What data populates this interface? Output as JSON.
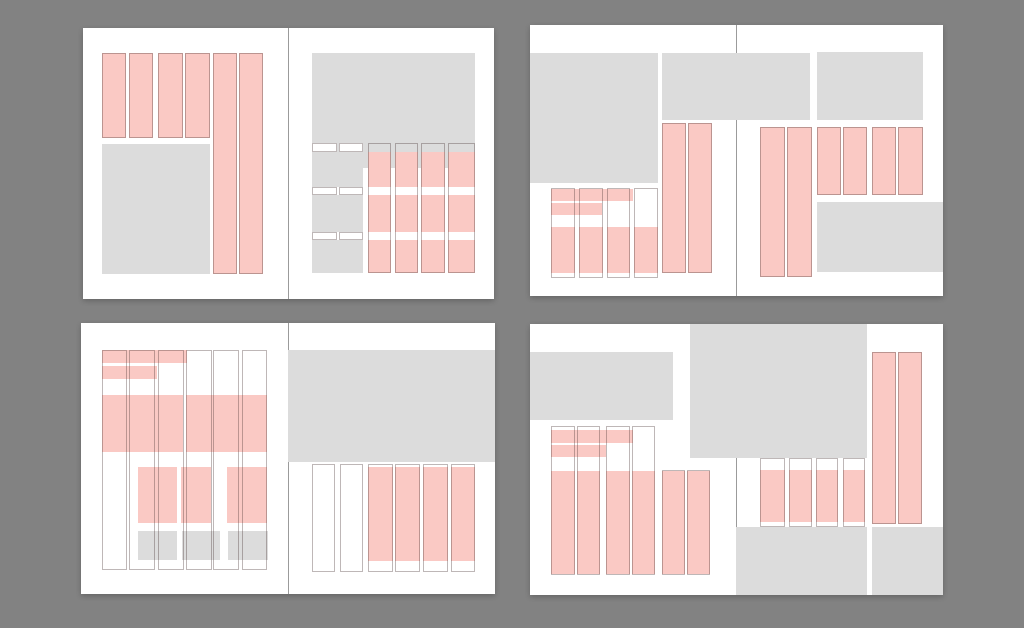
{
  "canvas": {
    "width": 1024,
    "height": 628,
    "background": "#828282"
  },
  "palette": {
    "background": "#828282",
    "page": "#ffffff",
    "image_block": "#dcdcdc",
    "text_block": "#fac9c4",
    "guide_line": "rgba(70,50,50,0.35)",
    "spine_line": "#9b9b9b"
  },
  "spreads": [
    {
      "name": "spread-top-left",
      "x": 83,
      "y": 28,
      "w": 411,
      "h": 271,
      "spine": 205,
      "blocks": [
        {
          "type": "text",
          "x": 19,
          "y": 25,
          "w": 24,
          "h": 85
        },
        {
          "type": "text",
          "x": 46,
          "y": 25,
          "w": 24,
          "h": 85
        },
        {
          "type": "text",
          "x": 75,
          "y": 25,
          "w": 25,
          "h": 85
        },
        {
          "type": "text",
          "x": 102,
          "y": 25,
          "w": 25,
          "h": 85
        },
        {
          "type": "text",
          "x": 130,
          "y": 25,
          "w": 24,
          "h": 221
        },
        {
          "type": "text",
          "x": 156,
          "y": 25,
          "w": 24,
          "h": 221
        },
        {
          "type": "image",
          "x": 19,
          "y": 116,
          "w": 108,
          "h": 130
        },
        {
          "type": "image",
          "x": 229,
          "y": 25,
          "w": 163,
          "h": 115
        },
        {
          "type": "caption",
          "x": 229,
          "y": 115,
          "w": 25,
          "h": 9
        },
        {
          "type": "caption",
          "x": 256,
          "y": 115,
          "w": 24,
          "h": 9
        },
        {
          "type": "image",
          "x": 229,
          "y": 124,
          "w": 51,
          "h": 35
        },
        {
          "type": "caption",
          "x": 229,
          "y": 159,
          "w": 25,
          "h": 8
        },
        {
          "type": "caption",
          "x": 256,
          "y": 159,
          "w": 24,
          "h": 8
        },
        {
          "type": "image",
          "x": 229,
          "y": 167,
          "w": 51,
          "h": 37
        },
        {
          "type": "caption",
          "x": 229,
          "y": 204,
          "w": 25,
          "h": 8
        },
        {
          "type": "caption",
          "x": 256,
          "y": 204,
          "w": 24,
          "h": 8
        },
        {
          "type": "image",
          "x": 229,
          "y": 212,
          "w": 51,
          "h": 33
        },
        {
          "type": "cell",
          "x": 285,
          "y": 124,
          "w": 23,
          "h": 35
        },
        {
          "type": "cell",
          "x": 312,
          "y": 124,
          "w": 23,
          "h": 35
        },
        {
          "type": "cell",
          "x": 338,
          "y": 124,
          "w": 24,
          "h": 35
        },
        {
          "type": "cell",
          "x": 365,
          "y": 124,
          "w": 27,
          "h": 35
        },
        {
          "type": "cell",
          "x": 285,
          "y": 167,
          "w": 23,
          "h": 37
        },
        {
          "type": "cell",
          "x": 312,
          "y": 167,
          "w": 23,
          "h": 37
        },
        {
          "type": "cell",
          "x": 338,
          "y": 167,
          "w": 24,
          "h": 37
        },
        {
          "type": "cell",
          "x": 365,
          "y": 167,
          "w": 27,
          "h": 37
        },
        {
          "type": "cell",
          "x": 285,
          "y": 212,
          "w": 23,
          "h": 33
        },
        {
          "type": "cell",
          "x": 312,
          "y": 212,
          "w": 23,
          "h": 33
        },
        {
          "type": "cell",
          "x": 338,
          "y": 212,
          "w": 24,
          "h": 33
        },
        {
          "type": "cell",
          "x": 365,
          "y": 212,
          "w": 27,
          "h": 33
        },
        {
          "type": "outline",
          "x": 285,
          "y": 115,
          "w": 23,
          "h": 130
        },
        {
          "type": "outline",
          "x": 312,
          "y": 115,
          "w": 23,
          "h": 130
        },
        {
          "type": "outline",
          "x": 338,
          "y": 115,
          "w": 24,
          "h": 130
        },
        {
          "type": "outline",
          "x": 365,
          "y": 115,
          "w": 27,
          "h": 130
        }
      ]
    },
    {
      "name": "spread-top-right",
      "x": 530,
      "y": 25,
      "w": 413,
      "h": 271,
      "spine": 206,
      "blocks": [
        {
          "type": "image",
          "x": 0,
          "y": 28,
          "w": 128,
          "h": 130
        },
        {
          "type": "image",
          "x": 132,
          "y": 28,
          "w": 148,
          "h": 67
        },
        {
          "type": "bar",
          "x": 21,
          "y": 164,
          "w": 82,
          "h": 12
        },
        {
          "type": "bar",
          "x": 21,
          "y": 178,
          "w": 51,
          "h": 12
        },
        {
          "type": "cell",
          "x": 21,
          "y": 202,
          "w": 24,
          "h": 46
        },
        {
          "type": "cell",
          "x": 49,
          "y": 202,
          "w": 24,
          "h": 46
        },
        {
          "type": "cell",
          "x": 77,
          "y": 202,
          "w": 23,
          "h": 46
        },
        {
          "type": "cell",
          "x": 104,
          "y": 202,
          "w": 24,
          "h": 46
        },
        {
          "type": "outline",
          "x": 21,
          "y": 163,
          "w": 24,
          "h": 90
        },
        {
          "type": "outline",
          "x": 49,
          "y": 163,
          "w": 24,
          "h": 90
        },
        {
          "type": "outline",
          "x": 77,
          "y": 163,
          "w": 23,
          "h": 90
        },
        {
          "type": "outline",
          "x": 104,
          "y": 163,
          "w": 24,
          "h": 90
        },
        {
          "type": "text",
          "x": 132,
          "y": 98,
          "w": 24,
          "h": 150
        },
        {
          "type": "text",
          "x": 158,
          "y": 98,
          "w": 24,
          "h": 150
        },
        {
          "type": "image",
          "x": 287,
          "y": 27,
          "w": 106,
          "h": 68
        },
        {
          "type": "text",
          "x": 230,
          "y": 102,
          "w": 25,
          "h": 150
        },
        {
          "type": "text",
          "x": 257,
          "y": 102,
          "w": 25,
          "h": 150
        },
        {
          "type": "text",
          "x": 287,
          "y": 102,
          "w": 24,
          "h": 68
        },
        {
          "type": "text",
          "x": 313,
          "y": 102,
          "w": 24,
          "h": 68
        },
        {
          "type": "text",
          "x": 342,
          "y": 102,
          "w": 24,
          "h": 68
        },
        {
          "type": "text",
          "x": 368,
          "y": 102,
          "w": 25,
          "h": 68
        },
        {
          "type": "image",
          "x": 287,
          "y": 177,
          "w": 126,
          "h": 70
        }
      ]
    },
    {
      "name": "spread-bottom-left",
      "x": 81,
      "y": 323,
      "w": 414,
      "h": 271,
      "spine": 207,
      "blocks": [
        {
          "type": "bar",
          "x": 21,
          "y": 27,
          "w": 85,
          "h": 13
        },
        {
          "type": "bar",
          "x": 21,
          "y": 43,
          "w": 55,
          "h": 13
        },
        {
          "type": "cell",
          "x": 21,
          "y": 72,
          "w": 81,
          "h": 57
        },
        {
          "type": "cell",
          "x": 105,
          "y": 72,
          "w": 81,
          "h": 57
        },
        {
          "type": "cell",
          "x": 57,
          "y": 144,
          "w": 39,
          "h": 56
        },
        {
          "type": "cell",
          "x": 100,
          "y": 144,
          "w": 30,
          "h": 56
        },
        {
          "type": "cell",
          "x": 146,
          "y": 144,
          "w": 40,
          "h": 56
        },
        {
          "type": "image",
          "x": 57,
          "y": 208,
          "w": 39,
          "h": 29
        },
        {
          "type": "image",
          "x": 101,
          "y": 208,
          "w": 38,
          "h": 29
        },
        {
          "type": "image",
          "x": 147,
          "y": 208,
          "w": 40,
          "h": 29
        },
        {
          "type": "outline",
          "x": 21,
          "y": 27,
          "w": 25,
          "h": 220
        },
        {
          "type": "outline",
          "x": 48,
          "y": 27,
          "w": 26,
          "h": 220
        },
        {
          "type": "outline",
          "x": 77,
          "y": 27,
          "w": 26,
          "h": 220
        },
        {
          "type": "outline",
          "x": 105,
          "y": 27,
          "w": 26,
          "h": 220
        },
        {
          "type": "outline",
          "x": 132,
          "y": 27,
          "w": 26,
          "h": 220
        },
        {
          "type": "outline",
          "x": 161,
          "y": 27,
          "w": 25,
          "h": 220
        },
        {
          "type": "image",
          "x": 207,
          "y": 27,
          "w": 207,
          "h": 112
        },
        {
          "type": "cell",
          "x": 287,
          "y": 144,
          "w": 25,
          "h": 94
        },
        {
          "type": "cell",
          "x": 314,
          "y": 144,
          "w": 25,
          "h": 94
        },
        {
          "type": "cell",
          "x": 342,
          "y": 144,
          "w": 25,
          "h": 94
        },
        {
          "type": "cell",
          "x": 370,
          "y": 144,
          "w": 24,
          "h": 94
        },
        {
          "type": "outline",
          "x": 231,
          "y": 141,
          "w": 23,
          "h": 108
        },
        {
          "type": "outline",
          "x": 259,
          "y": 141,
          "w": 23,
          "h": 108
        },
        {
          "type": "outline",
          "x": 287,
          "y": 141,
          "w": 25,
          "h": 108
        },
        {
          "type": "outline",
          "x": 314,
          "y": 141,
          "w": 25,
          "h": 108
        },
        {
          "type": "outline",
          "x": 342,
          "y": 141,
          "w": 25,
          "h": 108
        },
        {
          "type": "outline",
          "x": 370,
          "y": 141,
          "w": 24,
          "h": 108
        }
      ]
    },
    {
      "name": "spread-bottom-right",
      "x": 530,
      "y": 324,
      "w": 413,
      "h": 271,
      "spine": 206,
      "blocks": [
        {
          "type": "image",
          "x": 0,
          "y": 28,
          "w": 143,
          "h": 68
        },
        {
          "type": "image",
          "x": 160,
          "y": 0,
          "w": 177,
          "h": 134
        },
        {
          "type": "bar",
          "x": 21,
          "y": 106,
          "w": 82,
          "h": 13
        },
        {
          "type": "bar",
          "x": 21,
          "y": 121,
          "w": 55,
          "h": 12
        },
        {
          "type": "cell",
          "x": 21,
          "y": 147,
          "w": 24,
          "h": 103
        },
        {
          "type": "cell",
          "x": 47,
          "y": 147,
          "w": 23,
          "h": 103
        },
        {
          "type": "cell",
          "x": 76,
          "y": 147,
          "w": 24,
          "h": 103
        },
        {
          "type": "cell",
          "x": 102,
          "y": 147,
          "w": 23,
          "h": 103
        },
        {
          "type": "cell",
          "x": 132,
          "y": 147,
          "w": 23,
          "h": 103
        },
        {
          "type": "cell",
          "x": 157,
          "y": 147,
          "w": 23,
          "h": 103
        },
        {
          "type": "outline",
          "x": 21,
          "y": 102,
          "w": 24,
          "h": 149
        },
        {
          "type": "outline",
          "x": 47,
          "y": 102,
          "w": 23,
          "h": 149
        },
        {
          "type": "outline",
          "x": 76,
          "y": 102,
          "w": 24,
          "h": 149
        },
        {
          "type": "outline",
          "x": 102,
          "y": 102,
          "w": 23,
          "h": 149
        },
        {
          "type": "outline",
          "x": 132,
          "y": 146,
          "w": 23,
          "h": 105
        },
        {
          "type": "outline",
          "x": 157,
          "y": 146,
          "w": 23,
          "h": 105
        },
        {
          "type": "cell",
          "x": 230,
          "y": 146,
          "w": 25,
          "h": 52
        },
        {
          "type": "cell",
          "x": 259,
          "y": 146,
          "w": 23,
          "h": 52
        },
        {
          "type": "cell",
          "x": 286,
          "y": 146,
          "w": 22,
          "h": 52
        },
        {
          "type": "cell",
          "x": 313,
          "y": 146,
          "w": 22,
          "h": 52
        },
        {
          "type": "outline",
          "x": 230,
          "y": 134,
          "w": 25,
          "h": 69
        },
        {
          "type": "outline",
          "x": 259,
          "y": 134,
          "w": 23,
          "h": 69
        },
        {
          "type": "outline",
          "x": 286,
          "y": 134,
          "w": 22,
          "h": 69
        },
        {
          "type": "outline",
          "x": 313,
          "y": 134,
          "w": 22,
          "h": 69
        },
        {
          "type": "text",
          "x": 342,
          "y": 28,
          "w": 24,
          "h": 172
        },
        {
          "type": "text",
          "x": 368,
          "y": 28,
          "w": 24,
          "h": 172
        },
        {
          "type": "image",
          "x": 206,
          "y": 203,
          "w": 131,
          "h": 68
        },
        {
          "type": "image",
          "x": 342,
          "y": 203,
          "w": 71,
          "h": 68
        }
      ]
    }
  ]
}
